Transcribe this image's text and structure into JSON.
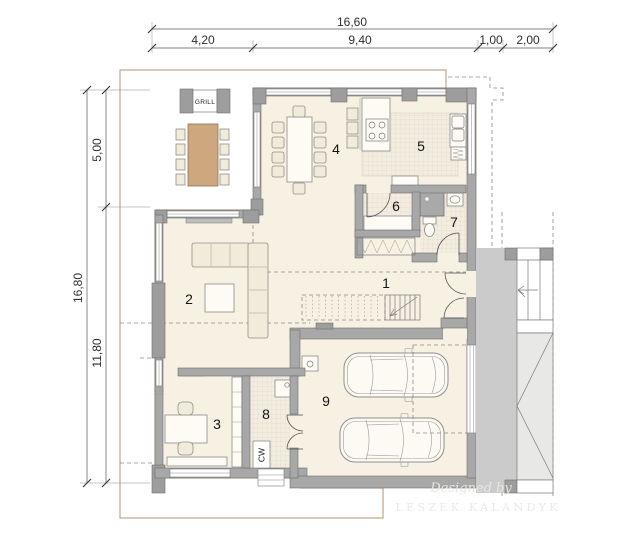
{
  "dimensions": {
    "top": {
      "total": "16,60",
      "segments": [
        "4,20",
        "9,40",
        "1,00",
        "2,00"
      ]
    },
    "left": {
      "total": "16,80",
      "segments": [
        "5,00",
        "11,80"
      ]
    }
  },
  "rooms": {
    "labels": [
      "1",
      "2",
      "3",
      "4",
      "5",
      "6",
      "7",
      "8",
      "9"
    ]
  },
  "annotations": {
    "grill": "GRILL",
    "utility_label": "CW"
  },
  "watermark": {
    "line1": "Designed by",
    "line2": "LESZEK KALANDYK"
  },
  "colors": {
    "deck": "#d3b18a",
    "deck_line": "#bf9e76",
    "floor": "#f7f1e3",
    "tile": "#f3ece0",
    "wall": "#a8a8a8",
    "wall_outline": "#6e6e6e",
    "paving": "#cbcbcb",
    "furniture": "#f1ebdb",
    "fixture": "#fdfbf4",
    "shower": "#a9a9a9",
    "dashed_line": "#8a8a8a",
    "dimension_text": "#2e2e2e",
    "room_label_text": "#141414",
    "watermark_text": "#e7e6e0"
  }
}
